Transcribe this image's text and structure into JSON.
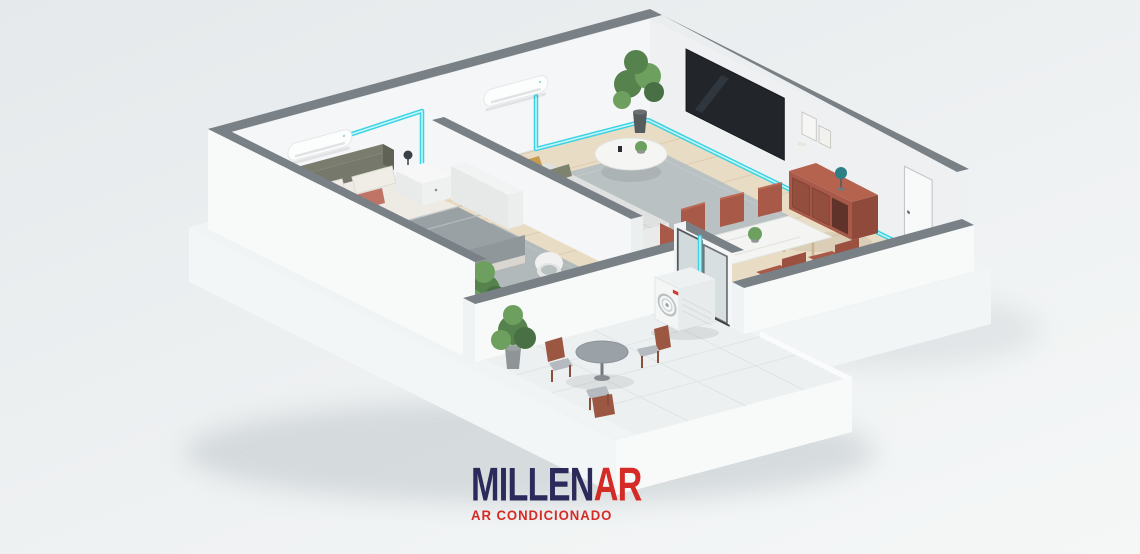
{
  "page": {
    "background_top": "#e5e9eb",
    "background_mid": "#eef1f2",
    "background_bottom": "#f5f7f7"
  },
  "logo": {
    "word_primary": "MILLEN",
    "word_accent": "AR",
    "tagline": "AR CONDICIONADO"
  },
  "colors": {
    "logo_navy": "#2b2a5a",
    "logo_red": "#d52b27",
    "pipe": "#39d3e3",
    "pipe_core": "#c9f6fa",
    "wall_cap": "#798187",
    "wall_face": "#f5f6f7",
    "wall_face_shade": "#eef0f1",
    "wall_exterior": "#f8fafa",
    "floor_wood": "#e9dcc4",
    "floor_plank_line": "#d8c6a7",
    "floor_balcony": "#edf0f0",
    "slab": "#f1f4f5",
    "shadow": "#bcc3c7",
    "rug_bedroom": "#aeb6ba",
    "rug_living": "#b7bfc2",
    "bed_blanket": "#9aa1a4",
    "bed_linen": "#edebe4",
    "headboard": "#75786a",
    "pillow_navy": "#3d4f63",
    "pillow_blue": "#aebac4",
    "pillow_terracotta": "#bf7466",
    "pillow_mustard": "#c79a4d",
    "sofa": "#dfe1e0",
    "tv_screen": "#22262b",
    "sideboard": "#a85948",
    "lamp_teal": "#2e7f86",
    "dining_chair": "#a85948",
    "cafe_chair_wood": "#9c5742",
    "cafe_table": "#9aa1a7",
    "plant": "#55824d",
    "plant_light": "#6da05e",
    "ac_body": "#fcfdfd",
    "outdoor_unit": "#f4f6f6",
    "fan": "#b9bfc2",
    "brand_red": "#d03a32",
    "glass": "#ccd6d8",
    "door_frame": "#3a3f44"
  }
}
